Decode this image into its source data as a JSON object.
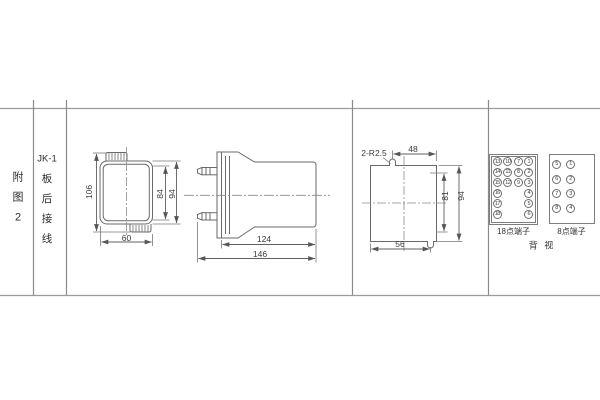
{
  "sidebar": {
    "figure_chars": [
      "附",
      "图",
      "2"
    ],
    "model": "JK-1",
    "wiring_chars": [
      "板",
      "后",
      "接",
      "线"
    ]
  },
  "front_view": {
    "height_overall": "106",
    "height_opening": "84",
    "height_case": "94",
    "width": "60"
  },
  "side_view": {
    "depth_body": "124",
    "depth_overall": "146"
  },
  "panel_cutout": {
    "corner_note": "2-R2.5",
    "offset_top": "48",
    "height_between_slots": "81",
    "height_overall": "94",
    "offset_bottom": "56"
  },
  "terminals": {
    "block_18": {
      "label": "18点端子",
      "rows": [
        [
          "13",
          "10",
          "7",
          "1"
        ],
        [
          "14",
          "11",
          "8",
          "2"
        ],
        [
          "15",
          "12",
          "9",
          "3"
        ],
        [
          "16",
          null,
          null,
          "4"
        ],
        [
          "17",
          null,
          null,
          "5"
        ],
        [
          "18",
          null,
          null,
          "6"
        ]
      ]
    },
    "block_8": {
      "label": "8点端子",
      "rows": [
        [
          "5",
          "1"
        ],
        [
          "6",
          "2"
        ],
        [
          "7",
          "3"
        ],
        [
          "8",
          "4"
        ]
      ]
    },
    "view_label": "背 视"
  },
  "colors": {
    "line": "#6a6a6a",
    "text": "#3a3a3a",
    "rule": "#9c9c9c"
  }
}
